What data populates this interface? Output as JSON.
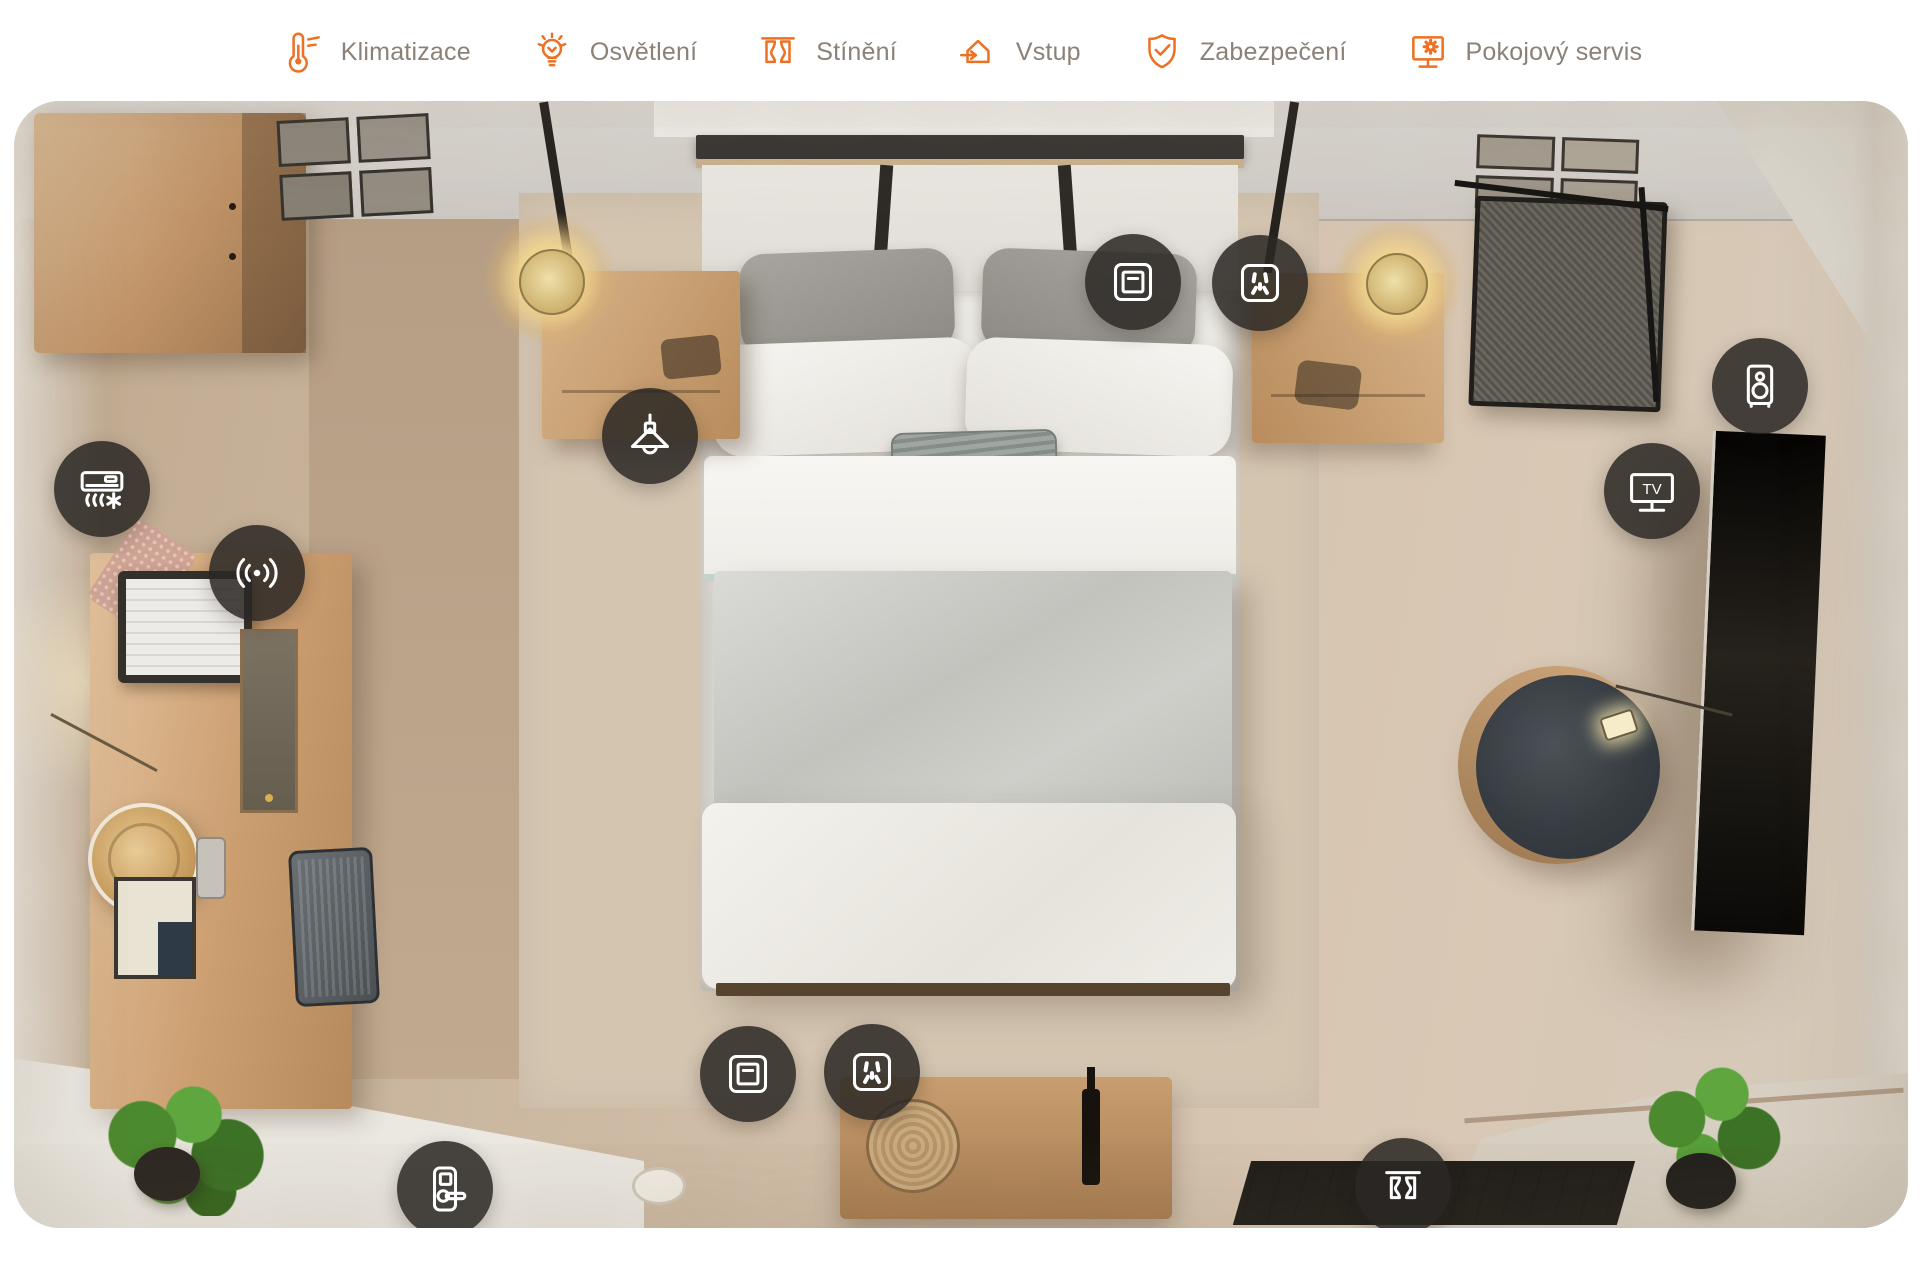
{
  "header": {
    "items": [
      {
        "id": "climate",
        "label": "Klimatizace",
        "icon": "thermometer-icon"
      },
      {
        "id": "lighting",
        "label": "Osvětlení",
        "icon": "lightbulb-icon"
      },
      {
        "id": "shading",
        "label": "Stínění",
        "icon": "curtains-icon"
      },
      {
        "id": "entry",
        "label": "Vstup",
        "icon": "house-enter-icon"
      },
      {
        "id": "security",
        "label": "Zabezpečení",
        "icon": "shield-check-icon"
      },
      {
        "id": "room_service",
        "label": "Pokojový servis",
        "icon": "service-screen-icon"
      }
    ]
  },
  "floorplan": {
    "tv_label": "TV",
    "hotspots": [
      {
        "id": "air-conditioning",
        "icon": "air-conditioner-icon"
      },
      {
        "id": "wireless-sensor",
        "icon": "signal-icon"
      },
      {
        "id": "pendant-light",
        "icon": "pendant-lamp-icon"
      },
      {
        "id": "light-switch-bedside",
        "icon": "light-switch-icon"
      },
      {
        "id": "power-socket-bedside",
        "icon": "power-socket-icon"
      },
      {
        "id": "speaker",
        "icon": "speaker-icon"
      },
      {
        "id": "television",
        "icon": "tv-icon"
      },
      {
        "id": "light-switch-entry",
        "icon": "light-switch-icon"
      },
      {
        "id": "power-socket-entry",
        "icon": "power-socket-icon"
      },
      {
        "id": "door-lock",
        "icon": "door-lock-icon"
      },
      {
        "id": "curtains",
        "icon": "curtains-icon"
      }
    ]
  },
  "colors": {
    "accent_orange": "#ee7023",
    "menu_text": "#8b8177",
    "badge_background": "rgba(43,40,36,0.86)",
    "badge_icon": "#ffffff"
  }
}
